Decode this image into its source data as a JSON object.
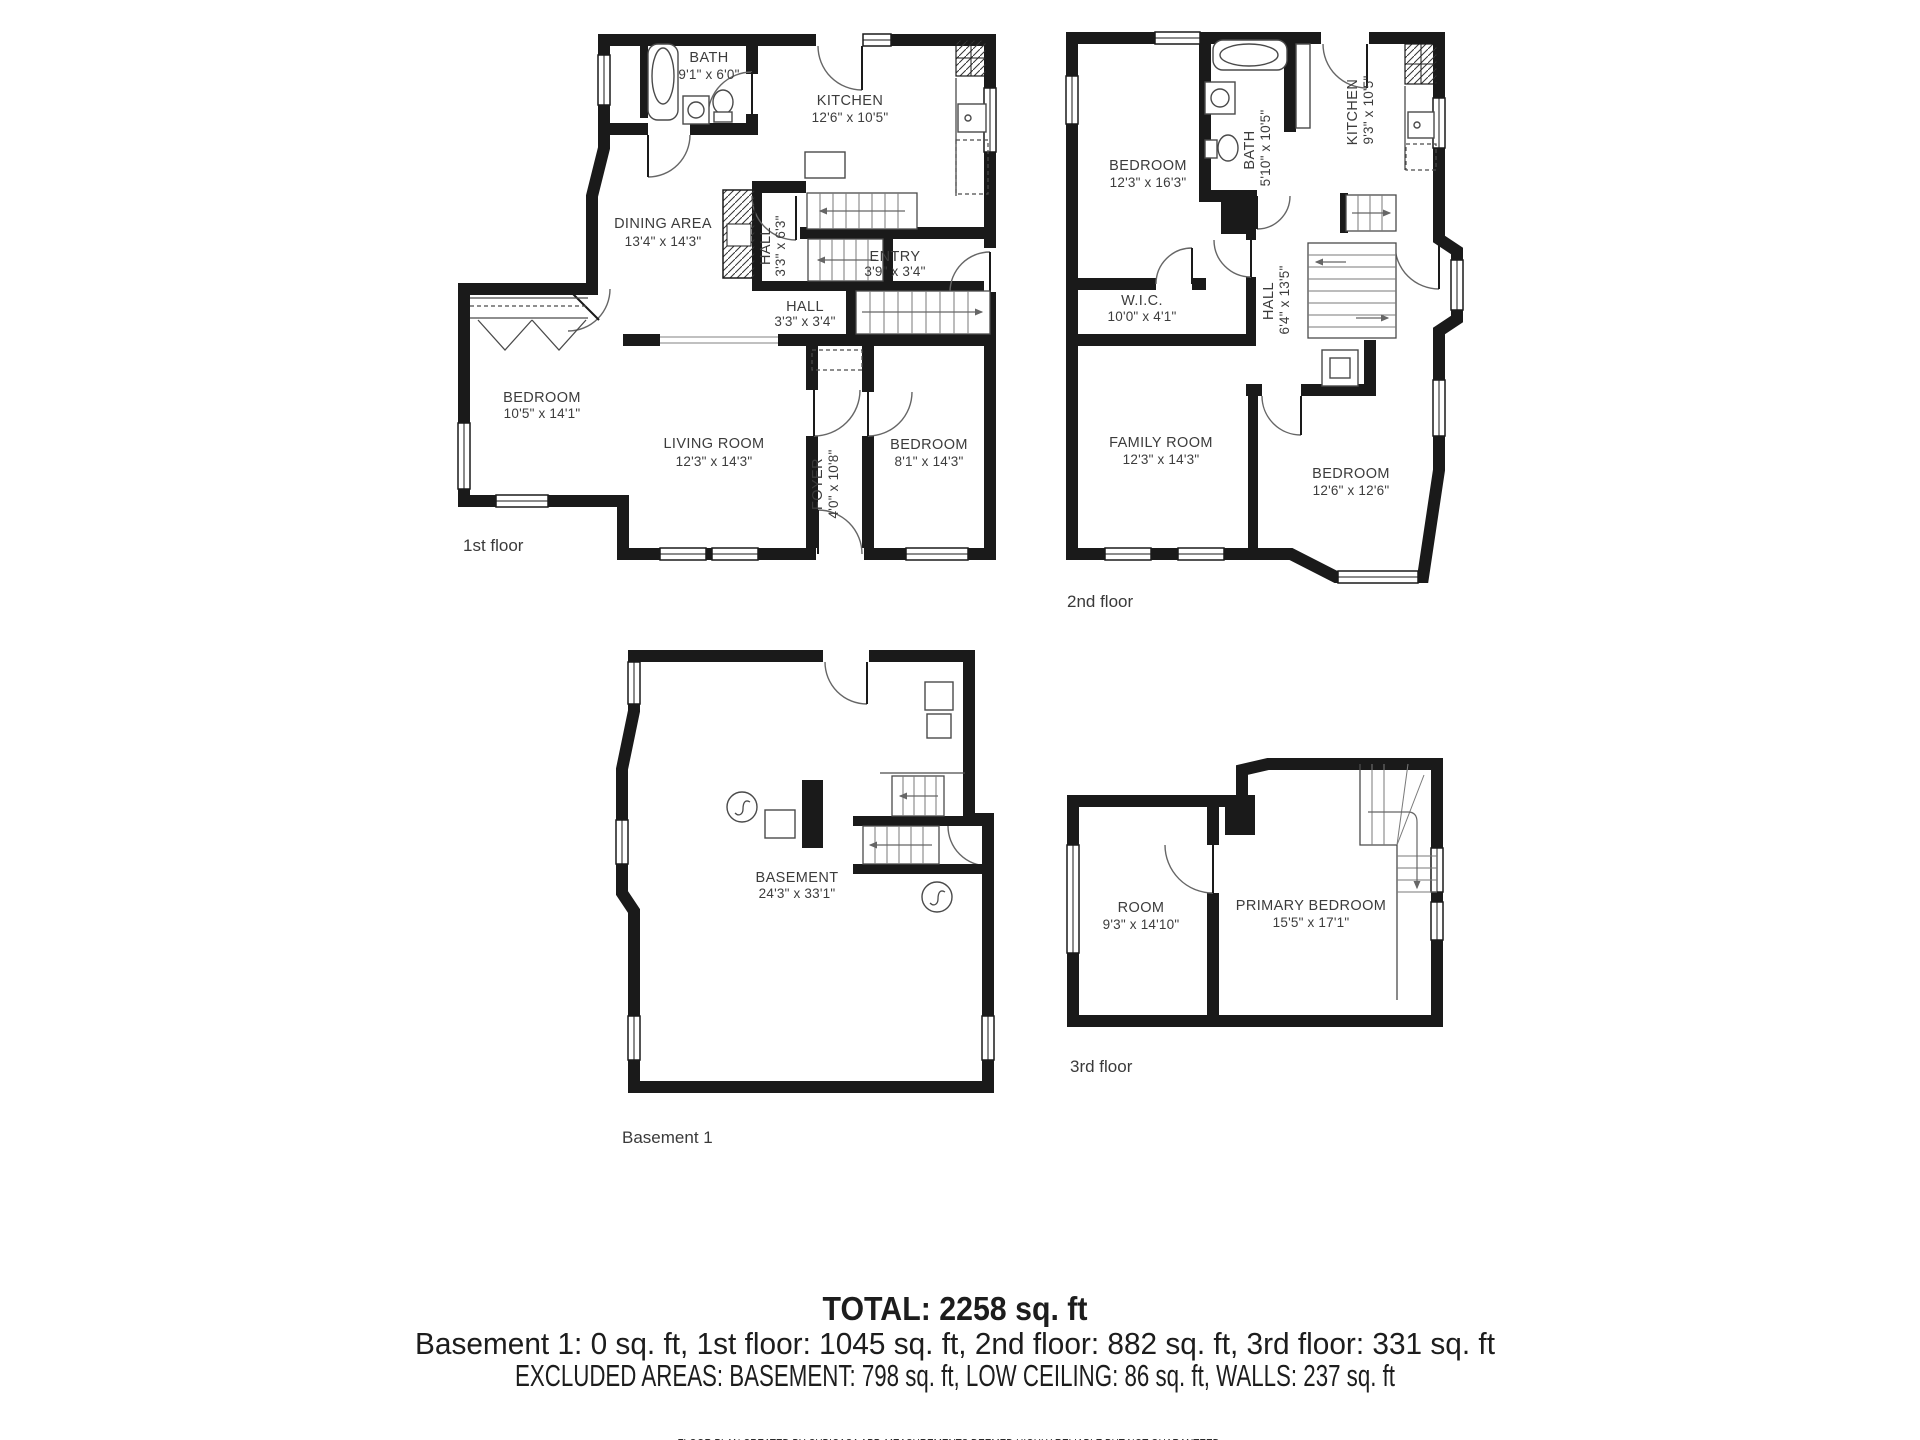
{
  "colors": {
    "wall": "#1a1a1a",
    "line": "#555555",
    "text": "#3c3c3c"
  },
  "floors": {
    "first": {
      "label": "1st floor",
      "rooms": {
        "bath": {
          "name": "BATH",
          "dims": "9'1\" x 6'0\""
        },
        "kitchen": {
          "name": "KITCHEN",
          "dims": "12'6\" x 10'5\""
        },
        "dining": {
          "name": "DINING AREA",
          "dims": "13'4\" x 14'3\""
        },
        "hall_upper": {
          "name": "HALL",
          "dims": "3'3\" x 6'3\""
        },
        "entry": {
          "name": "ENTRY",
          "dims": "3'9\" x 3'4\""
        },
        "hall_lower": {
          "name": "HALL",
          "dims": "3'3\" x 3'4\""
        },
        "bedroom_left": {
          "name": "BEDROOM",
          "dims": "10'5\" x 14'1\""
        },
        "living_room": {
          "name": "LIVING ROOM",
          "dims": "12'3\" x 14'3\""
        },
        "foyer": {
          "name": "FOYER",
          "dims": "4'0\" x 10'8\""
        },
        "bedroom_right": {
          "name": "BEDROOM",
          "dims": "8'1\" x 14'3\""
        }
      }
    },
    "second": {
      "label": "2nd floor",
      "rooms": {
        "bedroom": {
          "name": "BEDROOM",
          "dims": "12'3\" x 16'3\""
        },
        "bath": {
          "name": "BATH",
          "dims": "5'10\" x 10'5\""
        },
        "kitchen": {
          "name": "KITCHEN",
          "dims": "9'3\" x 10'5\""
        },
        "wic": {
          "name": "W.I.C.",
          "dims": "10'0\" x 4'1\""
        },
        "hall": {
          "name": "HALL",
          "dims": "6'4\" x 13'5\""
        },
        "family_room": {
          "name": "FAMILY ROOM",
          "dims": "12'3\" x 14'3\""
        },
        "bedroom2": {
          "name": "BEDROOM",
          "dims": "12'6\" x 12'6\""
        }
      }
    },
    "basement": {
      "label": "Basement 1",
      "rooms": {
        "basement": {
          "name": "BASEMENT",
          "dims": "24'3\" x 33'1\""
        }
      }
    },
    "third": {
      "label": "3rd floor",
      "rooms": {
        "room": {
          "name": "ROOM",
          "dims": "9'3\" x 14'10\""
        },
        "primary": {
          "name": "PRIMARY BEDROOM",
          "dims": "15'5\" x 17'1\""
        }
      }
    }
  },
  "summary": {
    "total": "TOTAL: 2258 sq. ft",
    "floors_line": "Basement 1: 0 sq. ft, 1st floor: 1045 sq. ft, 2nd floor: 882 sq. ft, 3rd floor: 331 sq. ft",
    "excluded_line": "EXCLUDED AREAS: BASEMENT: 798 sq. ft, LOW CEILING: 86 sq. ft, WALLS: 237 sq. ft",
    "disclaimer": "FLOOR PLAN CREATED BY CUBICASA APP. MEASUREMENTS DEEMED HIGHLY RELIABLE BUT NOT GUARANTEED."
  }
}
